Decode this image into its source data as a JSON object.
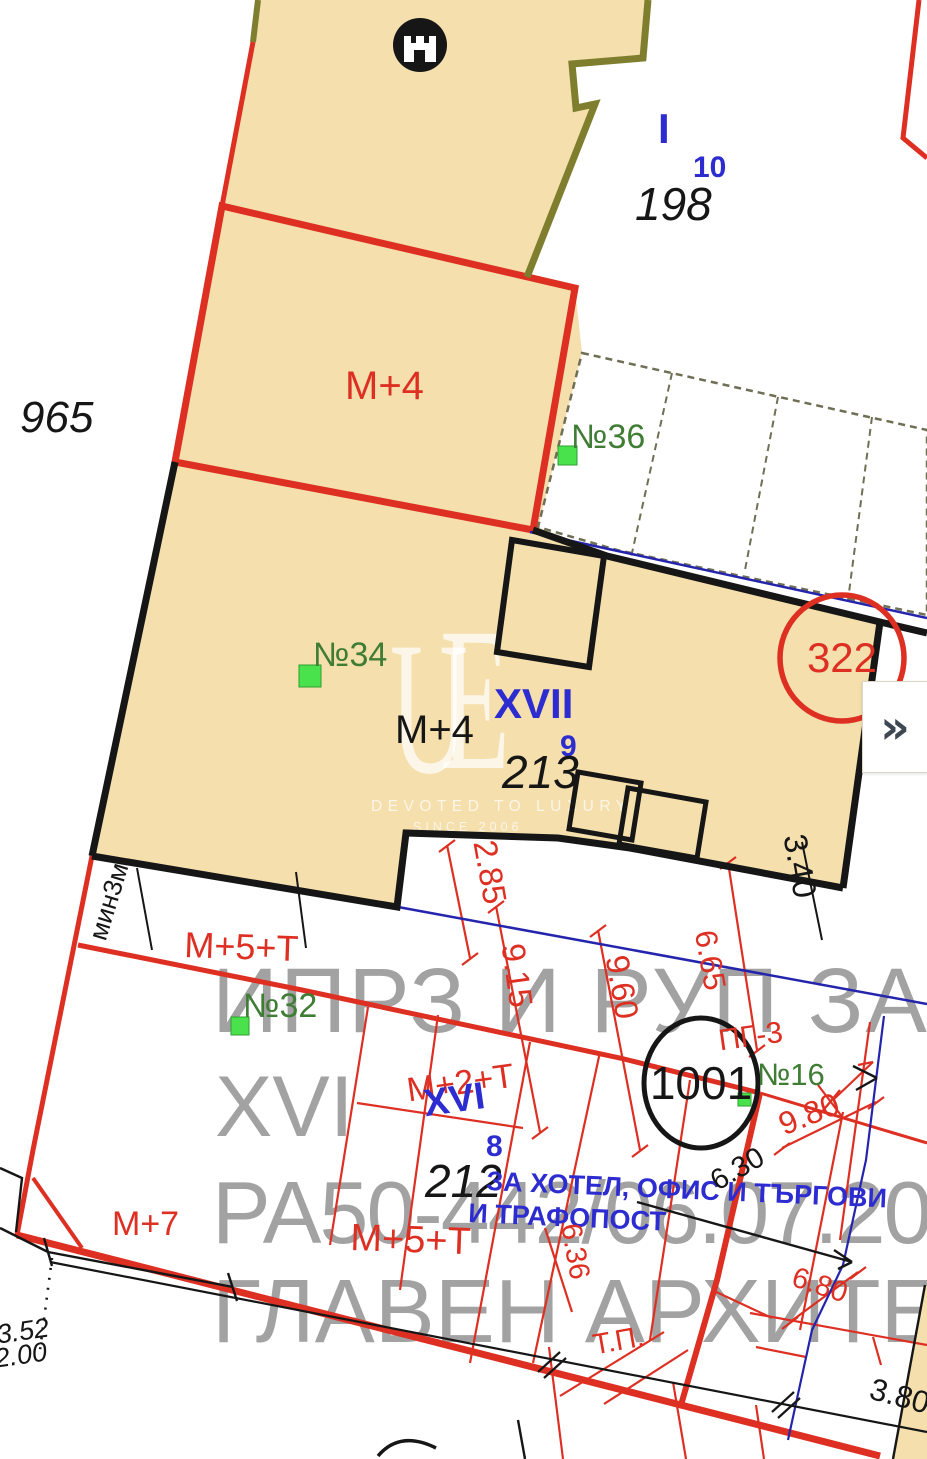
{
  "colors": {
    "tan": "#f4dfad",
    "tanDark": "#d7bc90",
    "red": "#dd2f22",
    "ink": "#161616",
    "olive": "#7f7e2e",
    "blueLine": "#2424ad",
    "blueText": "#2c2cd0",
    "green": "#3f7d35",
    "greenSq": "#49e24c",
    "grayW": "#8c8c8c"
  },
  "labels": {
    "topQuarter": {
      "roman": "I",
      "plot": "10",
      "number": "198"
    },
    "leftNumber": "965",
    "m4White": "M+4",
    "markers": {
      "b36": "№36",
      "b34": "№34",
      "b32": "№32",
      "b16": "№16"
    },
    "xvii": {
      "roman": "XVII",
      "plot": "9",
      "number": "213",
      "zoning": "M+4"
    },
    "xvi": {
      "roman": "XVI",
      "plot": "8",
      "number": "212",
      "zoningRed": "M+2+T"
    },
    "circles": {
      "c322": "322",
      "c1001": "1001"
    },
    "zoning": {
      "m5tUpper": "M+5+T",
      "m5tLower": "M+5+T",
      "m7": "M+7",
      "pg3": "ПГ-3",
      "tp": "Т.П.",
      "min3m": "мин3м"
    },
    "use": {
      "line1": "ЗА ХОТЕЛ, ОФИС И ТЪРГОВИ",
      "line2": "И ТРАФОПОСТ"
    },
    "dims": {
      "d285": "2.85",
      "d915": "9.15",
      "d960": "9.60",
      "d665": "6.65",
      "d980": "9.80",
      "d636": "6.36",
      "d680": "6.80",
      "d340": "3.40",
      "d630": "6.30",
      "d380": "3.80",
      "d352": "3.52",
      "d200": "2.00"
    }
  },
  "watermark": {
    "line1": "ИПРЗ  И РУП ЗА К",
    "line2": "XVI",
    "line3": "РА50-442/06.07.20",
    "line4": "ГЛАВЕН АРХИТЕК",
    "monogramU": "U",
    "monogramE": "E",
    "brand": "DEVOTED TO LUXURY",
    "since": "SINCE 2006"
  },
  "ui": {
    "expand": "»"
  }
}
